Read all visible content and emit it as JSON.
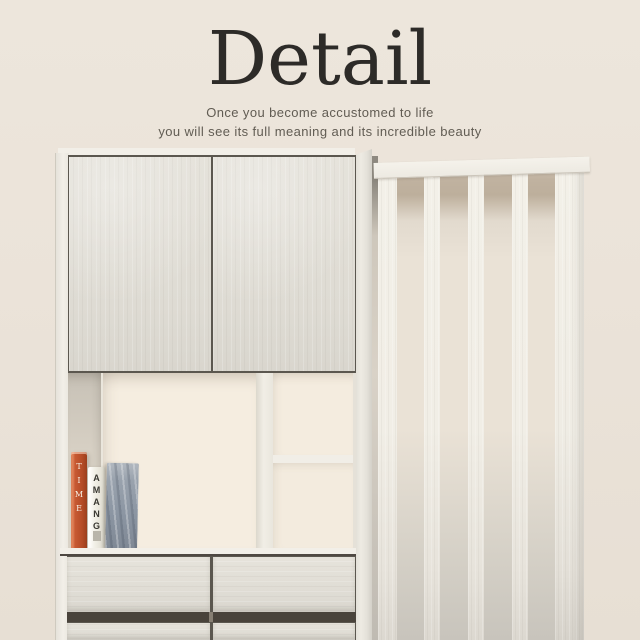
{
  "header": {
    "title": "Detail",
    "subtitle_line1": "Once you become accustomed to life",
    "subtitle_line2": "you will see its full meaning and its incredible beauty",
    "title_color": "#2d2b28",
    "subtitle_color": "#615c53"
  },
  "scene": {
    "background_color": "#ebe3d9",
    "cabinet": {
      "wood_color": "#e0ddd5",
      "frame_color": "#f0ede6",
      "interior_color": "#f4ecdf",
      "outline_color": "#57534c",
      "groove_color": "#49433b",
      "door_count": 2,
      "drawer_rows": 2,
      "drawers_per_row": 2
    },
    "partition": {
      "slat_color": "#f1ede5",
      "gap_top_color": "#bfb2a0",
      "inner_slat_count": 3
    },
    "books": [
      {
        "spine_text": "TIME",
        "spine_color": "#c0532f",
        "text_color": "#f8f3e8"
      },
      {
        "spine_text": "AMANG",
        "spine_color": "#f1efe6",
        "text_color": "#3a3832"
      },
      {
        "spine_text": "",
        "spine_color": "#8f99a5",
        "text_color": ""
      }
    ]
  }
}
